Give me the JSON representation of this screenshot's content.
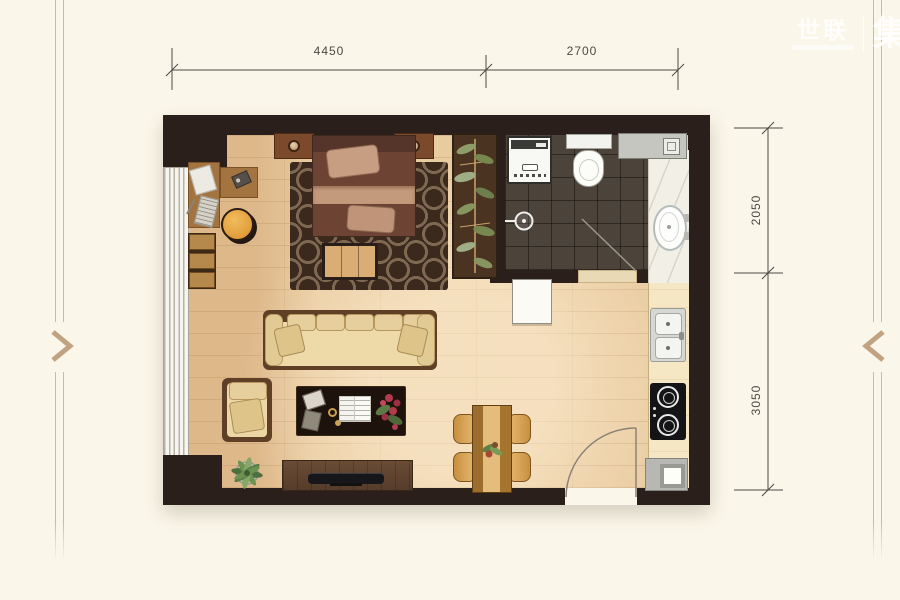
{
  "watermark": {
    "brand": "世联",
    "mark": "集"
  },
  "dimensions": {
    "top": [
      {
        "label": "4450"
      },
      {
        "label": "2700"
      }
    ],
    "right": [
      {
        "label": "2050"
      },
      {
        "label": "3050"
      }
    ]
  },
  "colors": {
    "page_background": "#faf6e9",
    "accent_tan": "#c2a381",
    "wall": "#2a1f1a",
    "wood_floor": "#e9cba0",
    "bathroom_tile": "#4c433b",
    "kitchen_counter": "#f5e7c4",
    "rug": "#3b291d",
    "dimension_text": "#4a4a45"
  }
}
